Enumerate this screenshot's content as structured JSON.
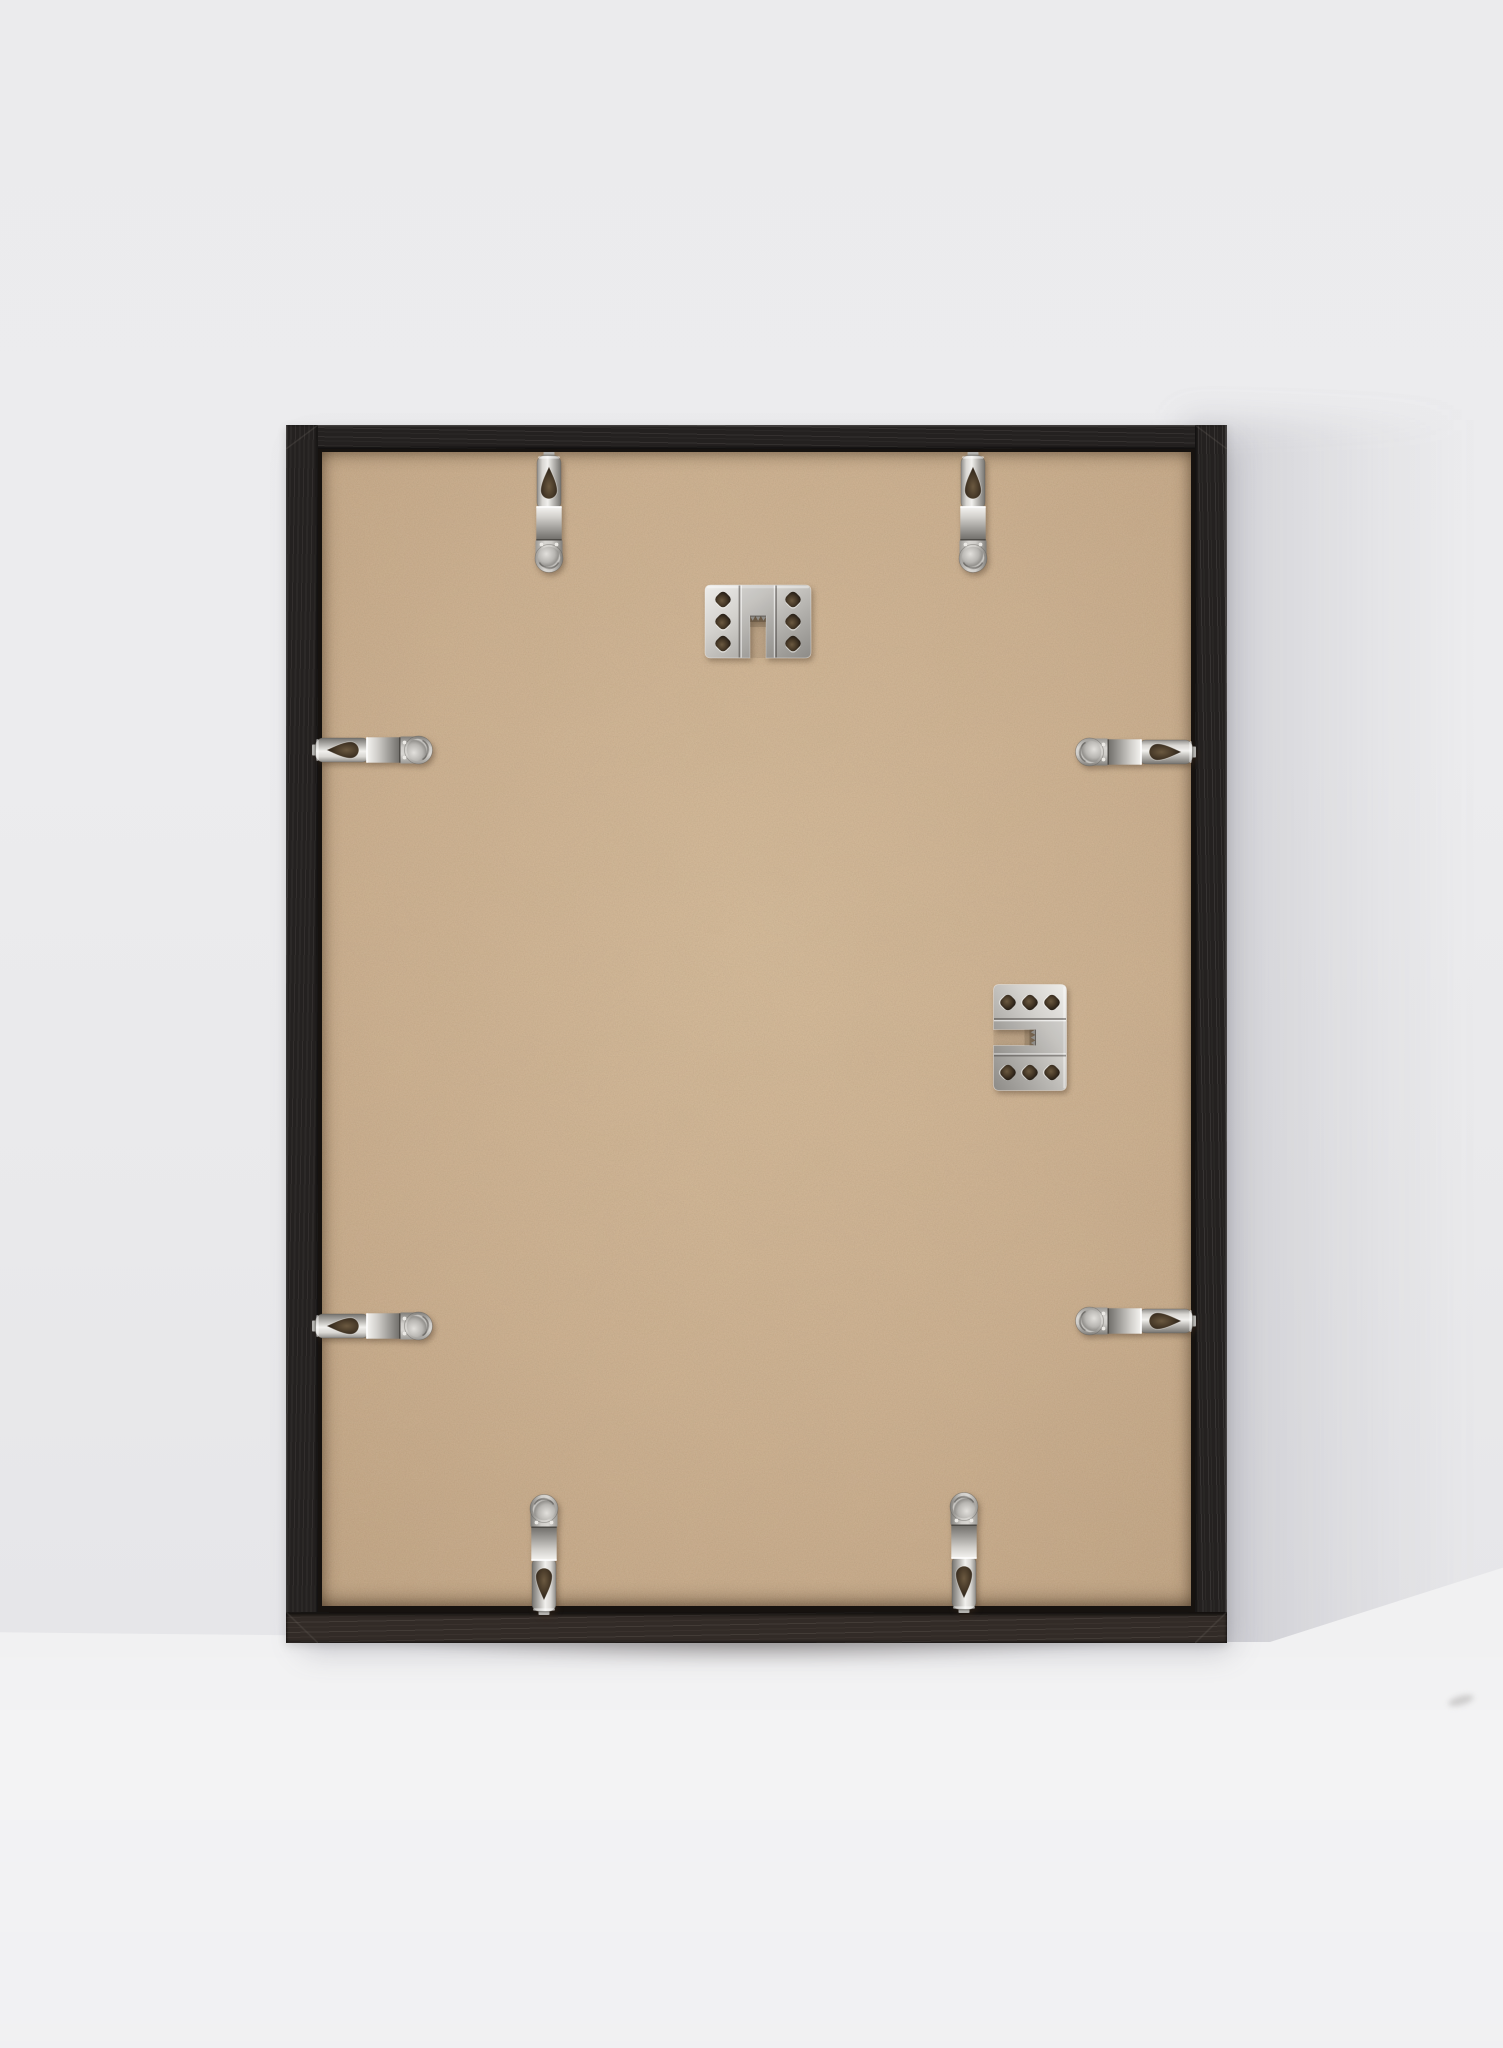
{
  "meta": {
    "type": "product-photograph",
    "subject": "Back view of a black wood picture frame with MDF backing board, leaning against a light grey wall",
    "canvas": {
      "width_px": 1503,
      "height_px": 2048
    }
  },
  "palette": {
    "wall": "#ececee",
    "floor": "#f2f2f3",
    "frame_wood": "#242120",
    "frame_wood_grain": "#4a4542",
    "frame_bottom_face": "#322b27",
    "frame_gap": "#16120f",
    "backing_center": "#d5b996",
    "backing_mid": "#ccae8c",
    "backing_edge": "#bfa07e",
    "metal_base": "#b9b7b2",
    "metal_highlight": "#f1f0ed",
    "metal_shadow": "#75736f",
    "hole_shadow": "#2a2118"
  },
  "frame": {
    "left": 286,
    "top": 425,
    "width": 941,
    "height": 1218,
    "molding_px": {
      "top": 24,
      "left": 32,
      "right": 32,
      "bottom": 31
    },
    "material": "black ash-grain wood",
    "backing_material": "tan MDF hardboard"
  },
  "hardware": {
    "clip_count": 8,
    "hanger_count": 2,
    "clips": [
      {
        "name": "top-left-spring-clip",
        "cx": 549,
        "cy": 514,
        "edge": "top"
      },
      {
        "name": "top-right-spring-clip",
        "cx": 973,
        "cy": 514,
        "edge": "top"
      },
      {
        "name": "left-upper-spring-clip",
        "cx": 374,
        "cy": 750,
        "edge": "left"
      },
      {
        "name": "right-upper-spring-clip",
        "cx": 1134,
        "cy": 752,
        "edge": "right"
      },
      {
        "name": "left-lower-spring-clip",
        "cx": 374,
        "cy": 1326,
        "edge": "left"
      },
      {
        "name": "right-lower-spring-clip",
        "cx": 1134,
        "cy": 1321,
        "edge": "right"
      },
      {
        "name": "bottom-left-spring-clip",
        "cx": 544,
        "cy": 1553,
        "edge": "bottom"
      },
      {
        "name": "bottom-right-spring-clip",
        "cx": 964,
        "cy": 1551,
        "edge": "bottom"
      }
    ],
    "hangers": [
      {
        "name": "sawtooth-hanger-portrait",
        "cx": 758,
        "cy": 621,
        "orientation": "notch-down"
      },
      {
        "name": "sawtooth-hanger-landscape",
        "cx": 1030,
        "cy": 1037,
        "orientation": "notch-left"
      }
    ]
  },
  "lighting": {
    "direction": "upper-left",
    "cast_shadow_side": "right",
    "floor_seam_y_px": 1632
  }
}
